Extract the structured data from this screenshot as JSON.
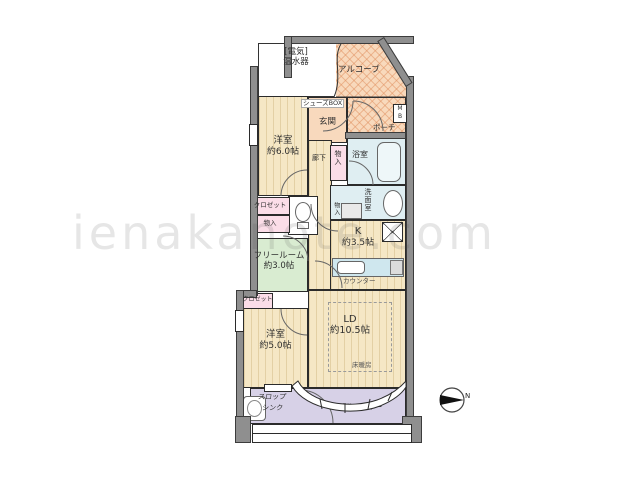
{
  "watermark": "ienakanote.com",
  "colors": {
    "wall_gray": "#8f8f8f",
    "room_beige": "#f5e7c5",
    "entrance_peach": "#f8d9bd",
    "hatch_peach": "#f8d9bc",
    "wet_area_blue": "#dfeef2",
    "counter_blue": "#cfe7ee",
    "storage_pink": "#fbdde8",
    "free_room_green": "#d9ecd1",
    "balcony_lavender": "#d7d1e7"
  },
  "rooms": {
    "water_heater": {
      "line1": "[電気]",
      "line2": "温水器"
    },
    "alcove": {
      "label": "アルコーブ"
    },
    "shoes_box": {
      "label": "シューズBOX"
    },
    "entrance": {
      "label": "玄関"
    },
    "porch": {
      "label": "ポーチ"
    },
    "meter_box": {
      "line1": "M",
      "line2": "B"
    },
    "bedroom1": {
      "name": "洋室",
      "size": "約6.0帖"
    },
    "hallway": {
      "label": "廊下"
    },
    "storage_hall": {
      "label": "物入"
    },
    "bathroom": {
      "label": "浴室"
    },
    "washroom": {
      "label": "洗面室"
    },
    "storage_washroom": {
      "label": "物入"
    },
    "closet_upper": {
      "label": "クロゼット"
    },
    "storage_upper": {
      "label": "物入"
    },
    "free_room": {
      "name": "フリールーム",
      "size": "約3.0帖"
    },
    "kitchen": {
      "name": "K",
      "size": "約3.5帖",
      "counter": "カウンター"
    },
    "closet_lower": {
      "label": "クロゼット"
    },
    "bedroom2": {
      "name": "洋室",
      "size": "約5.0帖"
    },
    "living_dining": {
      "name": "LD",
      "size": "約10.5帖",
      "floor_heating": "床暖房"
    },
    "slop_sink": {
      "line1": "スロップ",
      "line2": "シンク"
    },
    "balcony": {
      "label": "バルコニー"
    }
  },
  "compass": {
    "label": "N"
  }
}
